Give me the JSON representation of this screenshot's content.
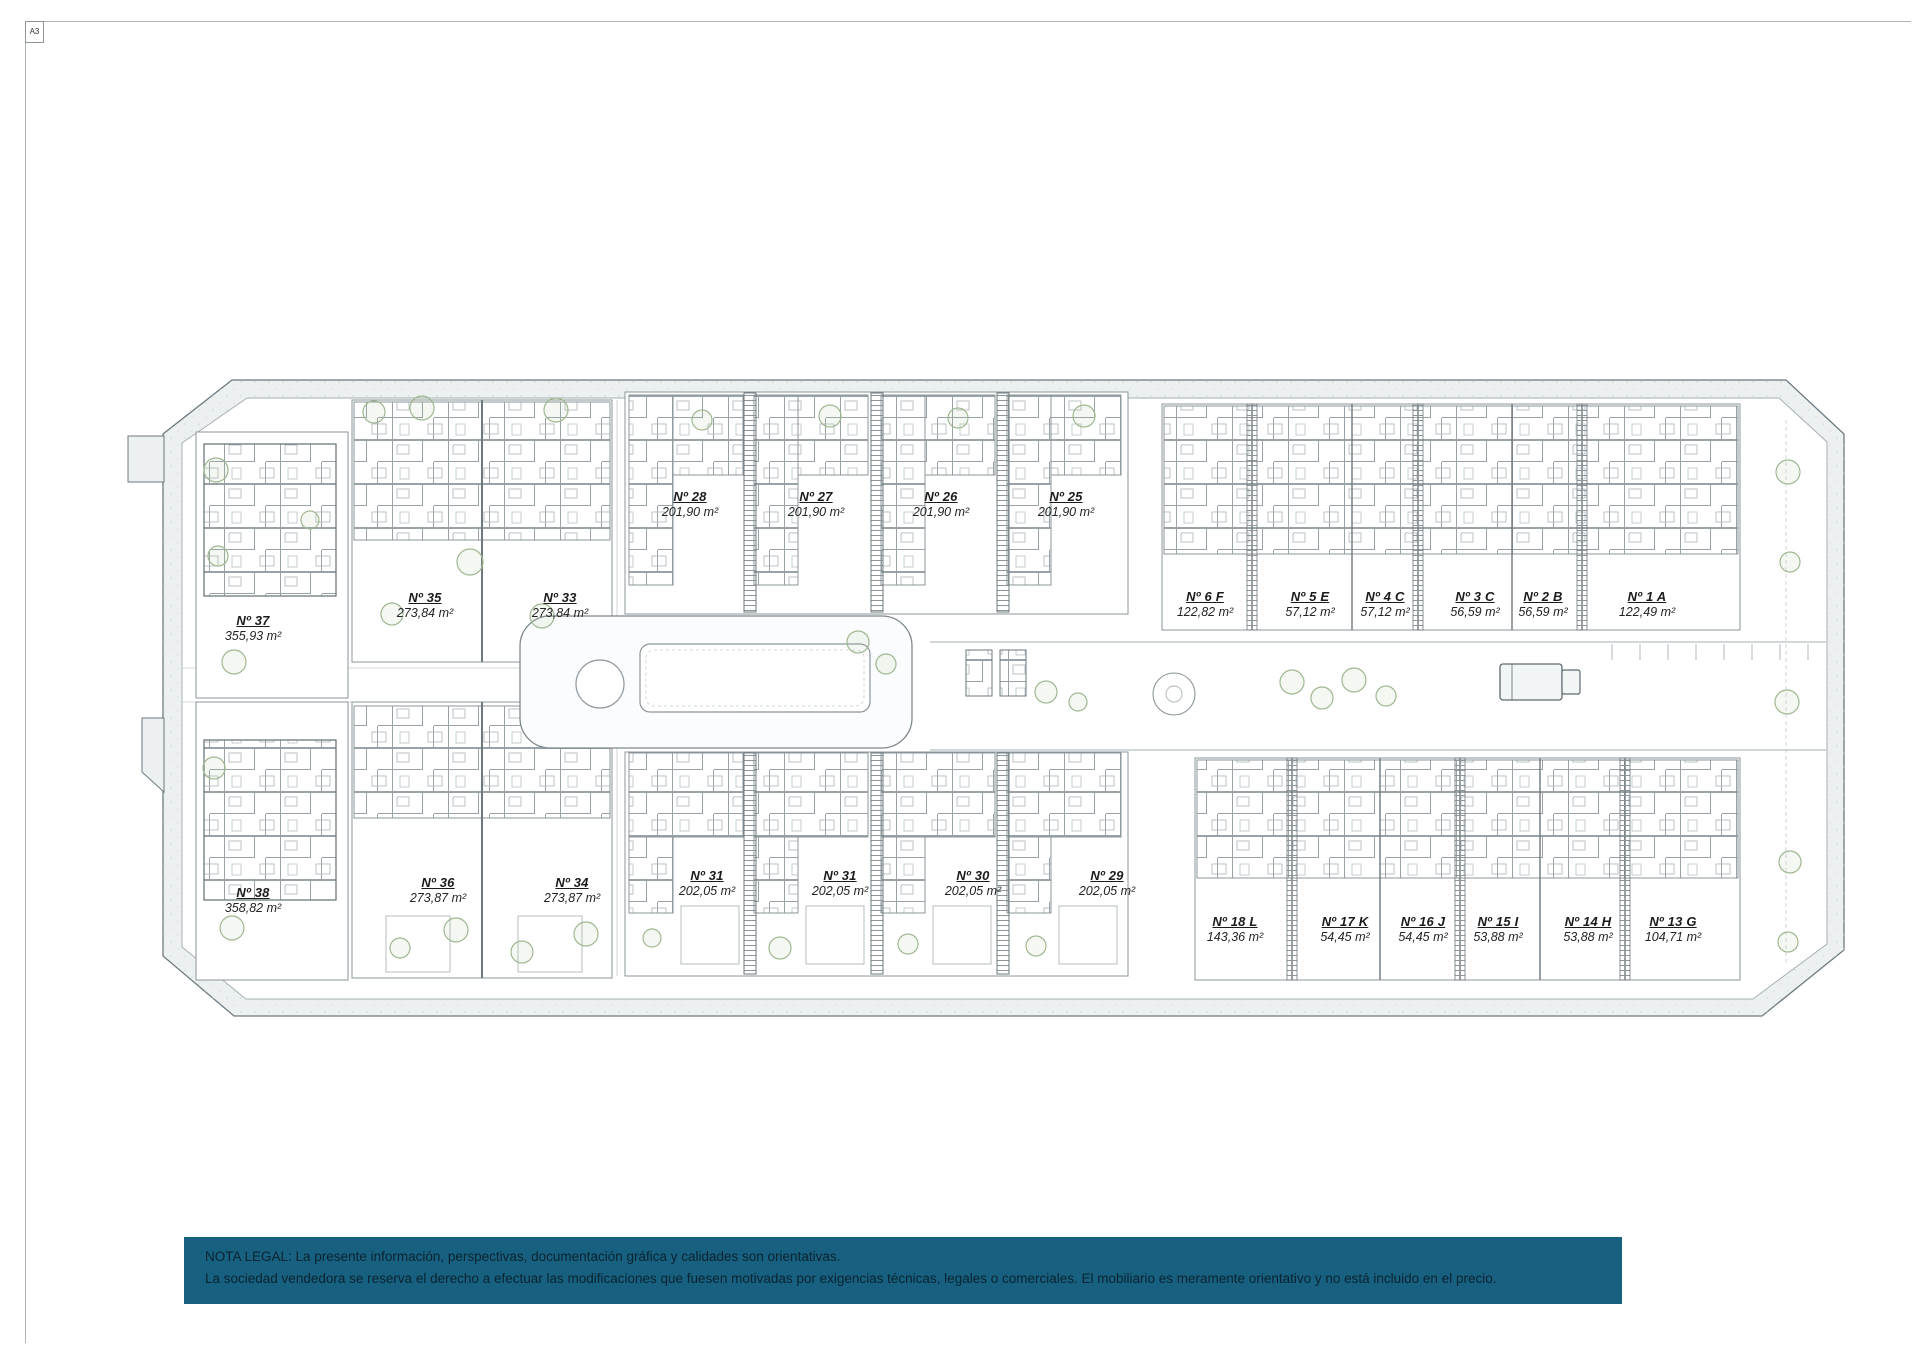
{
  "sheet": {
    "format_label": "A3"
  },
  "plan": {
    "units": [
      {
        "num": "Nº 37",
        "area": "355,93 m²"
      },
      {
        "num": "Nº 38",
        "area": "358,82 m²"
      },
      {
        "num": "Nº 35",
        "area": "273,84 m²"
      },
      {
        "num": "Nº 33",
        "area": "273,84 m²"
      },
      {
        "num": "Nº 36",
        "area": "273,87 m²"
      },
      {
        "num": "Nº 34",
        "area": "273,87 m²"
      },
      {
        "num": "Nº 28",
        "area": "201,90 m²"
      },
      {
        "num": "Nº 27",
        "area": "201,90 m²"
      },
      {
        "num": "Nº 26",
        "area": "201,90 m²"
      },
      {
        "num": "Nº 25",
        "area": "201,90 m²"
      },
      {
        "num": "Nº 31",
        "area": "202,05 m²"
      },
      {
        "num": "Nº 31",
        "area": "202,05 m²"
      },
      {
        "num": "Nº 30",
        "area": "202,05 m²"
      },
      {
        "num": "Nº 29",
        "area": "202,05 m²"
      },
      {
        "num": "Nº 6 F",
        "area": "122,82 m²"
      },
      {
        "num": "Nº 5 E",
        "area": "57,12 m²"
      },
      {
        "num": "Nº 4 C",
        "area": "57,12 m²"
      },
      {
        "num": "Nº 3 C",
        "area": "56,59 m²"
      },
      {
        "num": "Nº 2 B",
        "area": "56,59 m²"
      },
      {
        "num": "Nº 1 A",
        "area": "122,49 m²"
      },
      {
        "num": "Nº 18 L",
        "area": "143,36 m²"
      },
      {
        "num": "Nº 17 K",
        "area": "54,45 m²"
      },
      {
        "num": "Nº 16 J",
        "area": "54,45 m²"
      },
      {
        "num": "Nº 15 I",
        "area": "53,88 m²"
      },
      {
        "num": "Nº 14 H",
        "area": "53,88 m²"
      },
      {
        "num": "Nº 13 G",
        "area": "104,71 m²"
      }
    ]
  },
  "legal_note": {
    "line1": "NOTA LEGAL: La presente información, perspectivas, documentación gráfica y calidades son orientativas.",
    "line2": "La sociedad vendedora se reserva el derecho a efectuar las modificaciones que fuesen motivadas por exigencias técnicas, legales o comerciales. El mobiliario es meramente orientativo y no está incluido en el precio."
  },
  "colors": {
    "note_band": "#17607f",
    "sidewalk": "#edf0f1",
    "line": "#8b959a"
  }
}
